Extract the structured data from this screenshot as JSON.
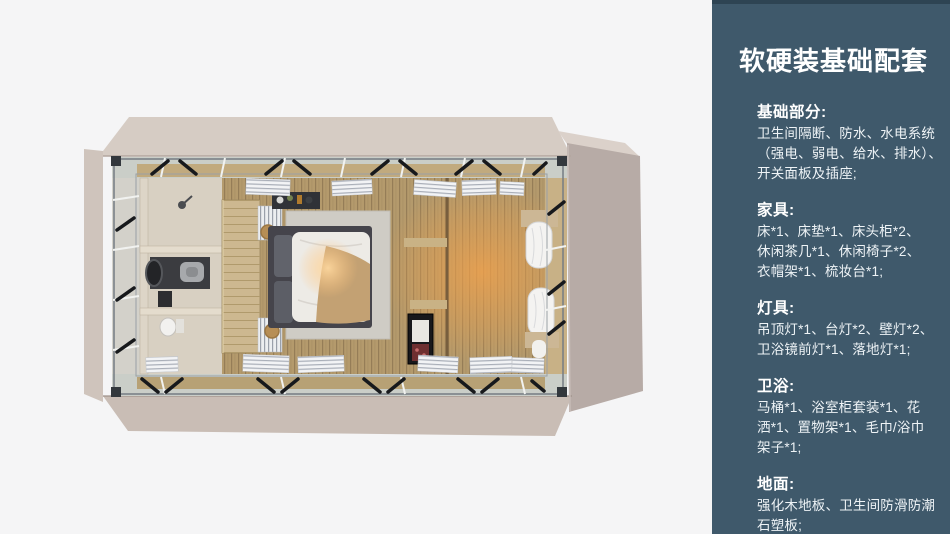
{
  "page": {
    "background": "#f5f5f6"
  },
  "panel": {
    "background": "#3f596b",
    "text_color": "#ffffff",
    "title": "软硬装基础配套",
    "sections": [
      {
        "heading": "基础部分:",
        "lines": [
          "卫生间隔断、防水、水电系统",
          "（强电、弱电、给水、排水）、",
          "开关面板及插座;"
        ]
      },
      {
        "heading": "家具:",
        "lines": [
          "床*1、床垫*1、床头柜*2、",
          "休闲茶几*1、休闲椅子*2、",
          "衣帽架*1、梳妆台*1;"
        ]
      },
      {
        "heading": "灯具:",
        "lines": [
          "吊顶灯*1、台灯*2、壁灯*2、",
          "卫浴镜前灯*1、落地灯*1;"
        ]
      },
      {
        "heading": "卫浴:",
        "lines": [
          "马桶*1、浴室柜套装*1、花",
          "洒*1、置物架*1、毛巾/浴巾",
          "架子*1;"
        ]
      },
      {
        "heading": "地面:",
        "lines": [
          "强化木地板、卫生间防滑防潮",
          "石塑板;"
        ]
      }
    ]
  },
  "floorplan": {
    "palette": {
      "wall_top": "#d6ccc4",
      "wall_left": "#cfc4bc",
      "wall_bottom": "#c9bdb5",
      "wall_right": "#b7aba6",
      "frame_band": "#cacec8",
      "floor_wood": "#b49a6c",
      "bathroom_tile": "#d8d0c2",
      "partition_wood": "#cdb890",
      "rug_gray": "#cfccc5",
      "bed_frame": "#45444b",
      "bedding_white": "#edebe6",
      "blanket_tan": "#c3a173",
      "curtain_white": "#f4f3f1",
      "cabinet_black": "#18181b",
      "brace_black": "#17191c",
      "glow_orange": "#f09c45"
    }
  }
}
